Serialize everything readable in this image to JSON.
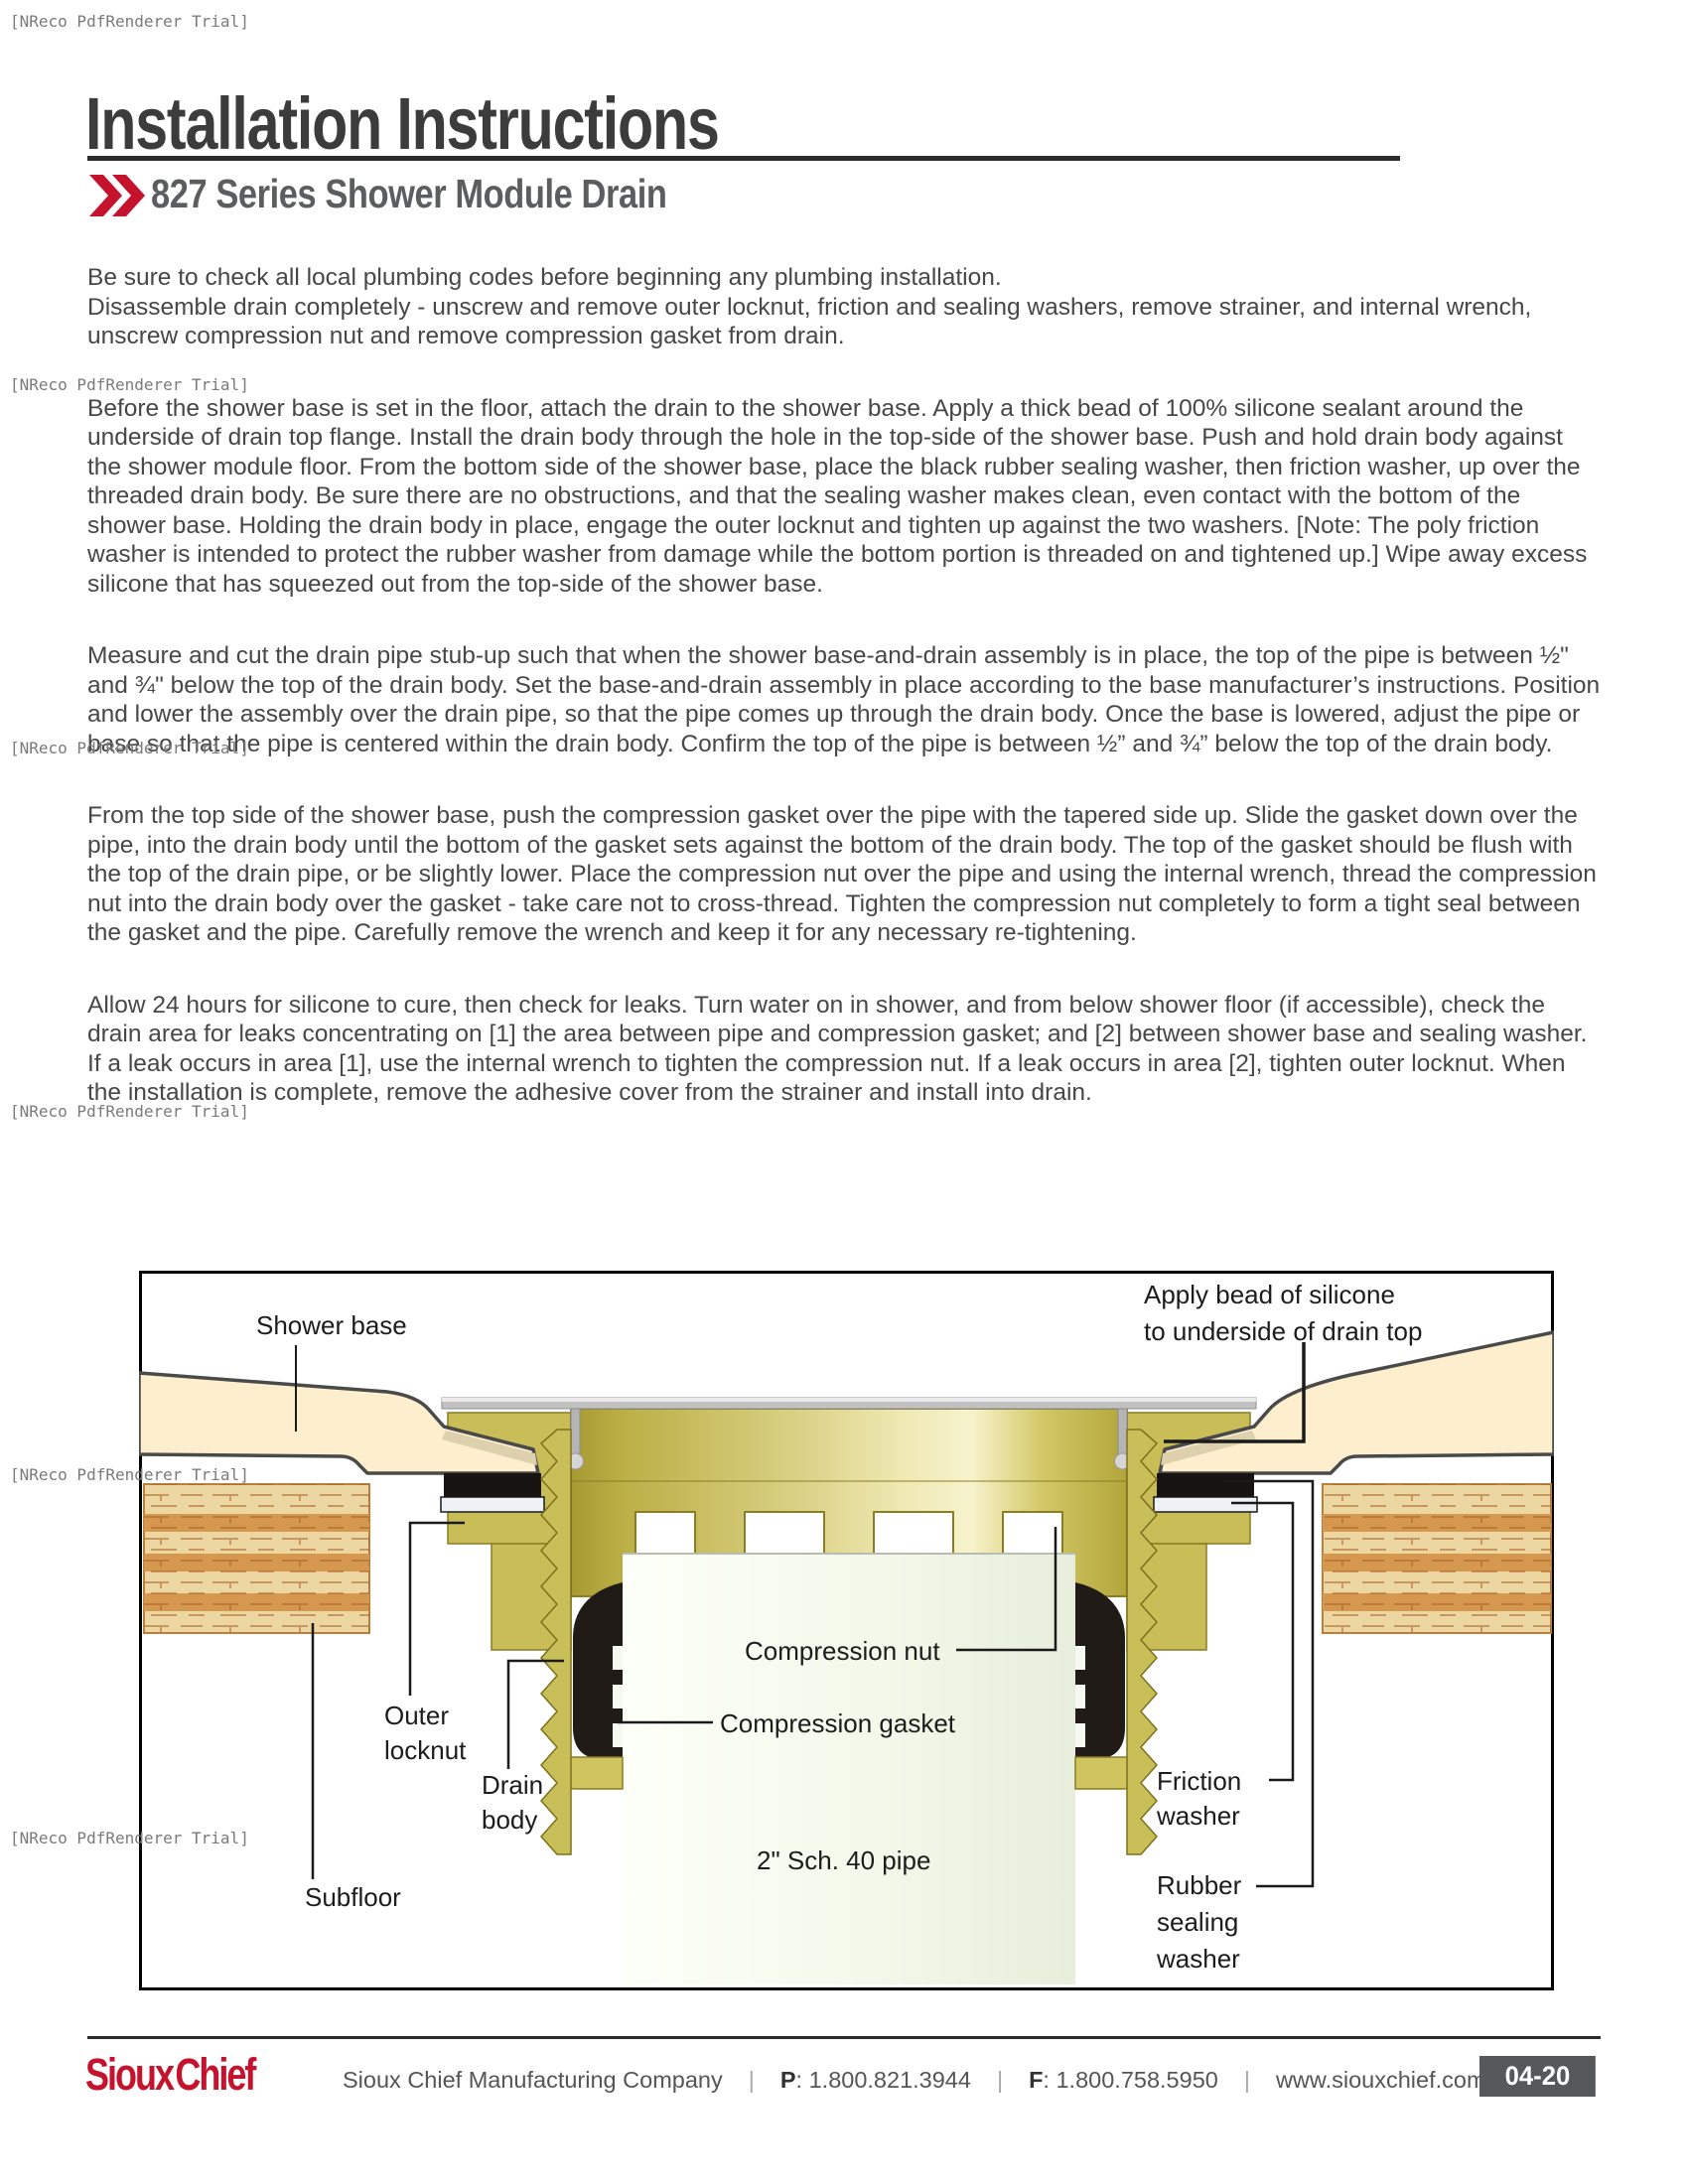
{
  "watermark": {
    "text": "[NReco PdfRenderer Trial]"
  },
  "header": {
    "title": "Installation Instructions",
    "subtitle": "827 Series Shower Module Drain"
  },
  "paragraphs": [
    "Be sure to check all local plumbing codes before beginning any plumbing installation.\nDisassemble drain completely - unscrew and remove outer locknut, friction and sealing washers, remove strainer, and internal wrench, unscrew compression nut and remove compression gasket from drain.",
    "Before the shower base is set in the floor, attach the drain to the shower base. Apply a thick bead of 100% silicone sealant around the underside of drain top flange. Install the drain body through the hole in the top-side of the shower base. Push and hold drain body against the shower module floor. From the bottom side of the shower base, place the black rubber sealing washer, then friction washer, up over the threaded drain body. Be sure there are no obstructions, and that the sealing washer makes clean, even contact with the bottom of the shower base. Holding the drain body in place, engage the outer locknut and tighten up against the two washers. [Note: The poly friction washer is intended to protect the rubber washer from damage while the bottom portion is threaded on and tightened up.] Wipe away excess silicone that has squeezed out from the top-side of the shower base.",
    "Measure and cut the drain pipe stub-up such that when the shower base-and-drain assembly is in place, the top of the pipe is between ½\" and ¾\" below the top of the drain body. Set the base-and-drain assembly in place according to the base manufacturer’s instructions. Position and lower the assembly over the drain pipe, so that the pipe comes up through the drain body. Once the base is lowered, adjust the pipe or base so that the pipe is centered within the drain body. Confirm the top of the pipe is between ½” and ¾” below the top of the drain body.",
    "From the top side of the shower base, push the compression gasket over the pipe with the tapered side up. Slide the gasket down over the pipe, into the drain body until the bottom of the gasket sets against the bottom of the drain body. The top of the gasket should be flush with the top of the drain pipe, or be slightly lower. Place the compression nut over the pipe and using the internal wrench, thread the compression nut into the drain body over the gasket - take care not to cross-thread. Tighten the compression nut completely to form a tight seal between the gasket and the pipe. Carefully remove the wrench and keep it for any necessary re-tightening.",
    "Allow 24 hours for silicone to cure, then check for leaks. Turn water on in shower, and from below shower floor (if accessible), check the drain area for leaks concentrating on [1] the area between pipe and compression gasket; and [2] between shower base and sealing washer. If a leak occurs in area [1], use the internal wrench to tighten the compression nut. If a leak occurs in area [2], tighten outer locknut. When the installation is complete, remove the adhesive cover from the strainer and install into drain."
  ],
  "diagram": {
    "labels": {
      "shower_base": "Shower base",
      "apply_bead": [
        "Apply bead of silicone",
        "to underside of drain top"
      ],
      "outer_locknut": [
        "Outer",
        "locknut"
      ],
      "drain_body": [
        "Drain",
        "body"
      ],
      "subfloor": "Subfloor",
      "compression_nut": "Compression nut",
      "compression_gasket": "Compression gasket",
      "pipe": "2\" Sch. 40 pipe",
      "friction_washer": [
        "Friction",
        "washer"
      ],
      "rubber_sealing_washer": [
        "Rubber",
        "sealing",
        "washer"
      ]
    }
  },
  "footer": {
    "logo": "Sioux Chief",
    "company": "Sioux Chief Manufacturing Company",
    "separator": "|",
    "phone_label": "P",
    "phone_number": ": 1.800.821.3944",
    "fax_label": "F",
    "fax_number": ": 1.800.758.5950",
    "website": "www.siouxchief.com",
    "page_code": "04-20"
  },
  "colors": {
    "accent_red": "#c5122d",
    "brass": "#c9bd58",
    "cream": "#fdeecd",
    "page_box_gray": "#57585a"
  }
}
